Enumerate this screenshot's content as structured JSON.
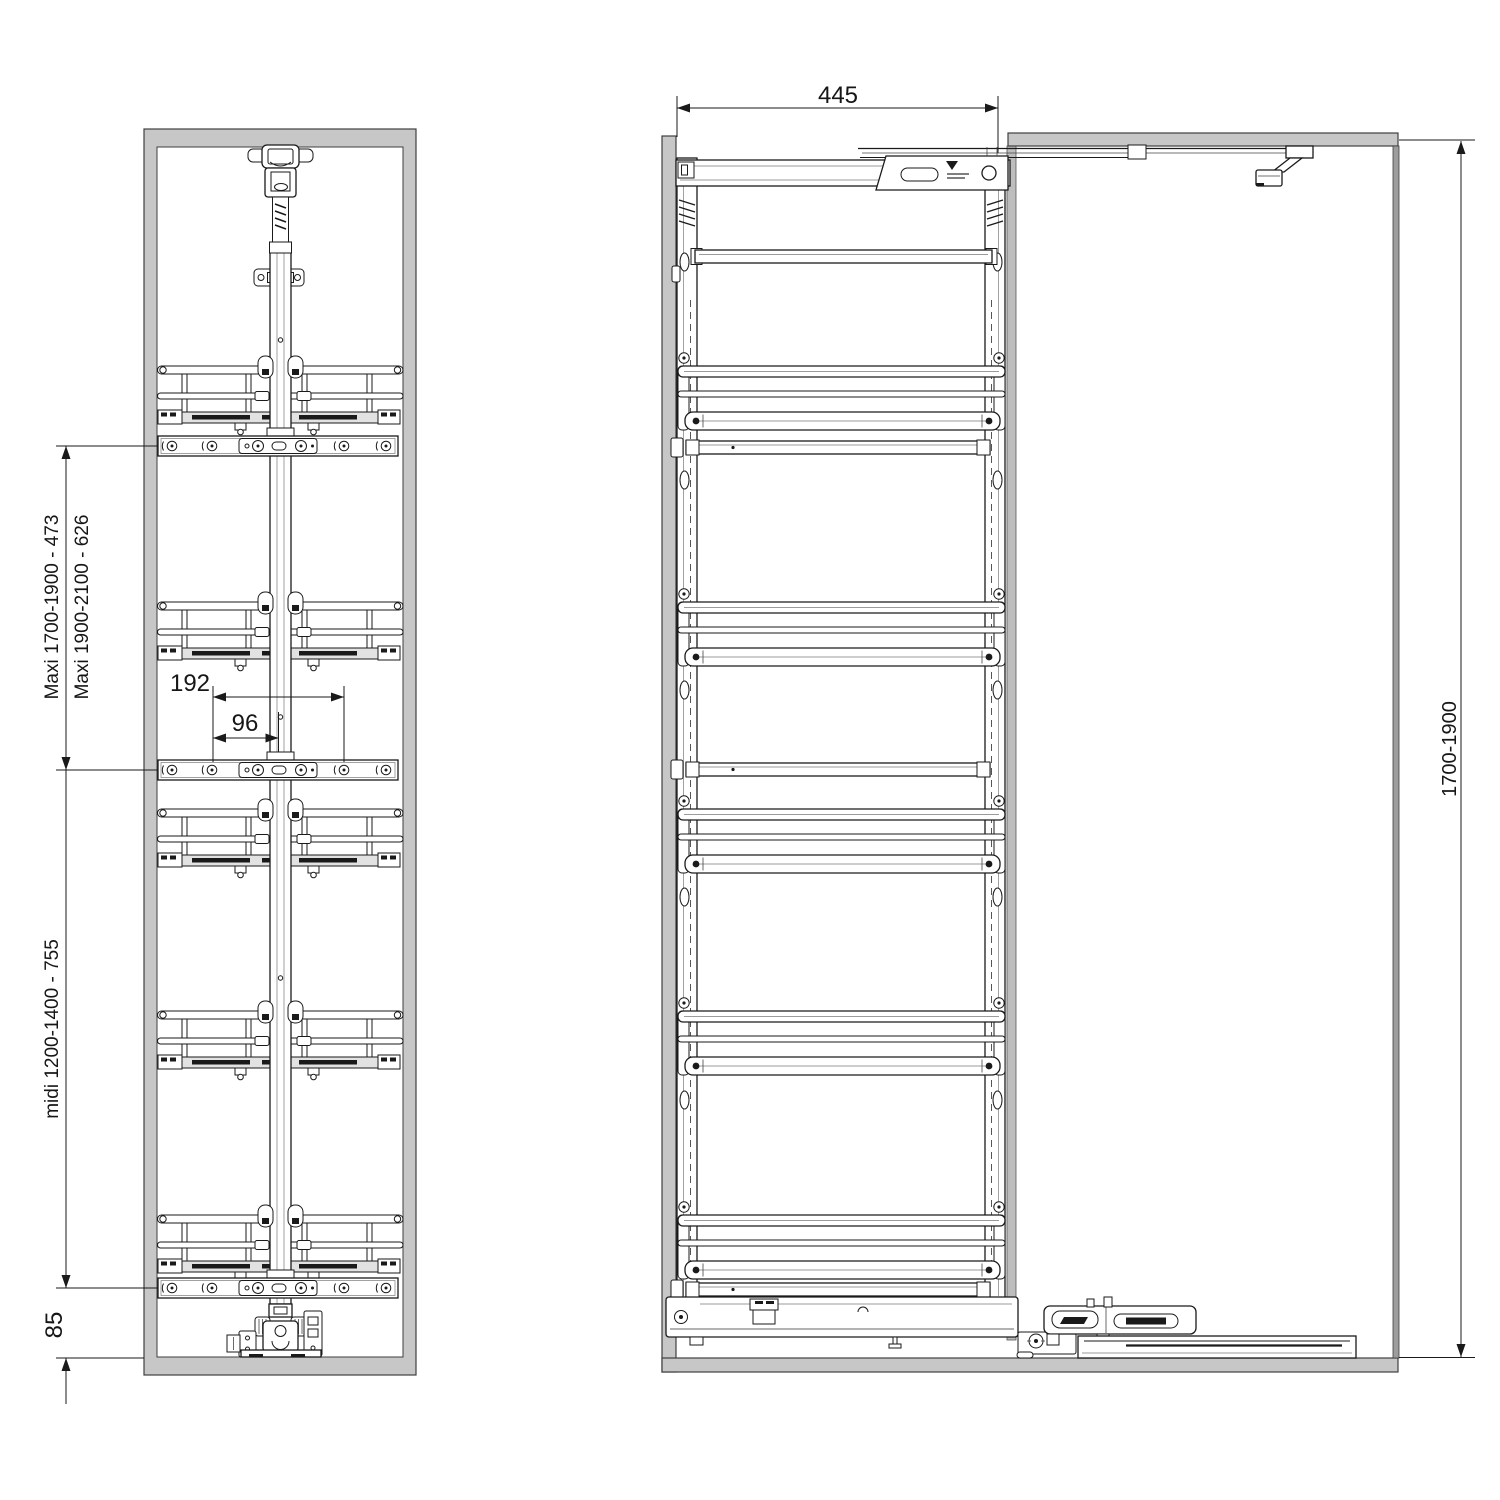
{
  "drawing": {
    "front_view": {
      "upper_span_label_1": "Maxi 1700-1900 - 473",
      "upper_span_label_2": "Maxi 1900-2100 - 626",
      "lower_span_label": "midi 1200-1400 - 755",
      "bottom_offset_label": "85",
      "hole_spacing_label": "192",
      "hole_to_center_label": "96"
    },
    "side_view": {
      "depth_label": "445",
      "height_label": "1700-1900"
    },
    "colors": {
      "cabinet_gray": "#c7c7c7",
      "line_color": "#1a1a1a"
    }
  }
}
